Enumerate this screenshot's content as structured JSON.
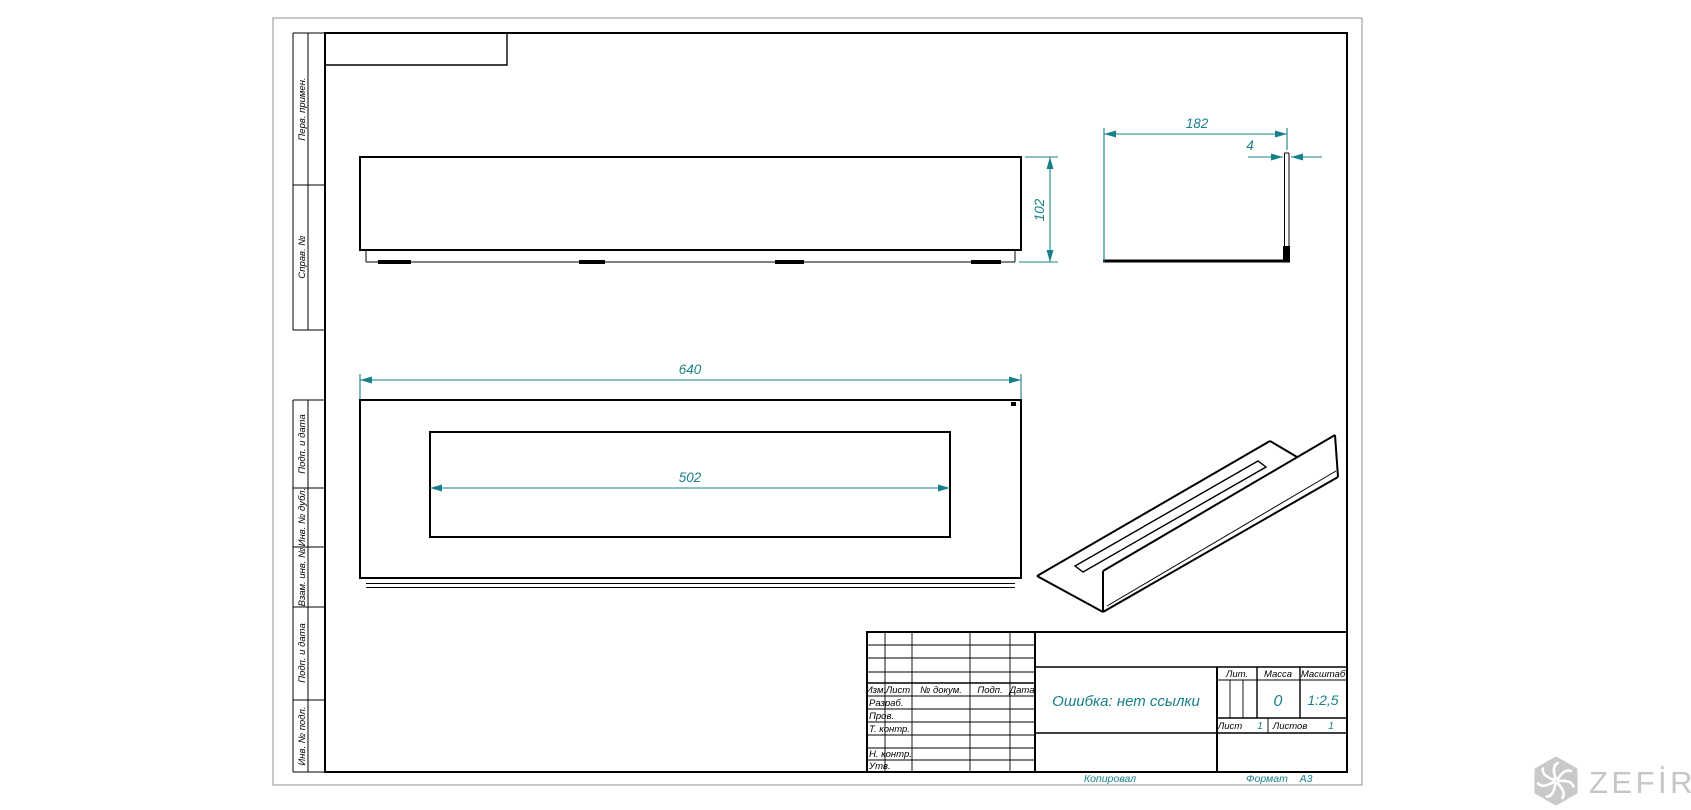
{
  "frame": {
    "margin_labels_top": [
      "Перв. примен.",
      "Справ. №"
    ],
    "margin_labels_bottom": [
      "Подп. и дата",
      "Инв. № дубл.",
      "Взам. инв. №",
      "Подп. и дата",
      "Инв. № подл."
    ]
  },
  "dims": {
    "length": "640",
    "opening": "502",
    "height": "102",
    "depth": "182",
    "thickness": "4"
  },
  "title_block": {
    "header": {
      "izm": "Изм.",
      "list": "Лист",
      "doc": "№ докум.",
      "podp": "Подп.",
      "data": "Дата"
    },
    "rows": {
      "razrab": "Разраб.",
      "prov": "Пров.",
      "tkontr": "Т. контр.",
      "nkontr": "Н. контр.",
      "utv": "Утв."
    },
    "doc_title": "Ошибка: нет ссылки",
    "lit_label": "Лит.",
    "mass_label": "Масса",
    "scale_label": "Масштаб",
    "mass_value": "0",
    "scale_value": "1:2,5",
    "list_label": "Лист",
    "list_value": "1",
    "listov_label": "Листов",
    "listov_value": "1"
  },
  "footer": {
    "kopiroval": "Копировал",
    "format_label": "Формат",
    "format_value": "А3"
  },
  "logo": {
    "text": "ZEFİRE"
  },
  "colors": {
    "dimension": "#17808A",
    "line": "#000000",
    "logo_gray": "#C7C7C7"
  }
}
